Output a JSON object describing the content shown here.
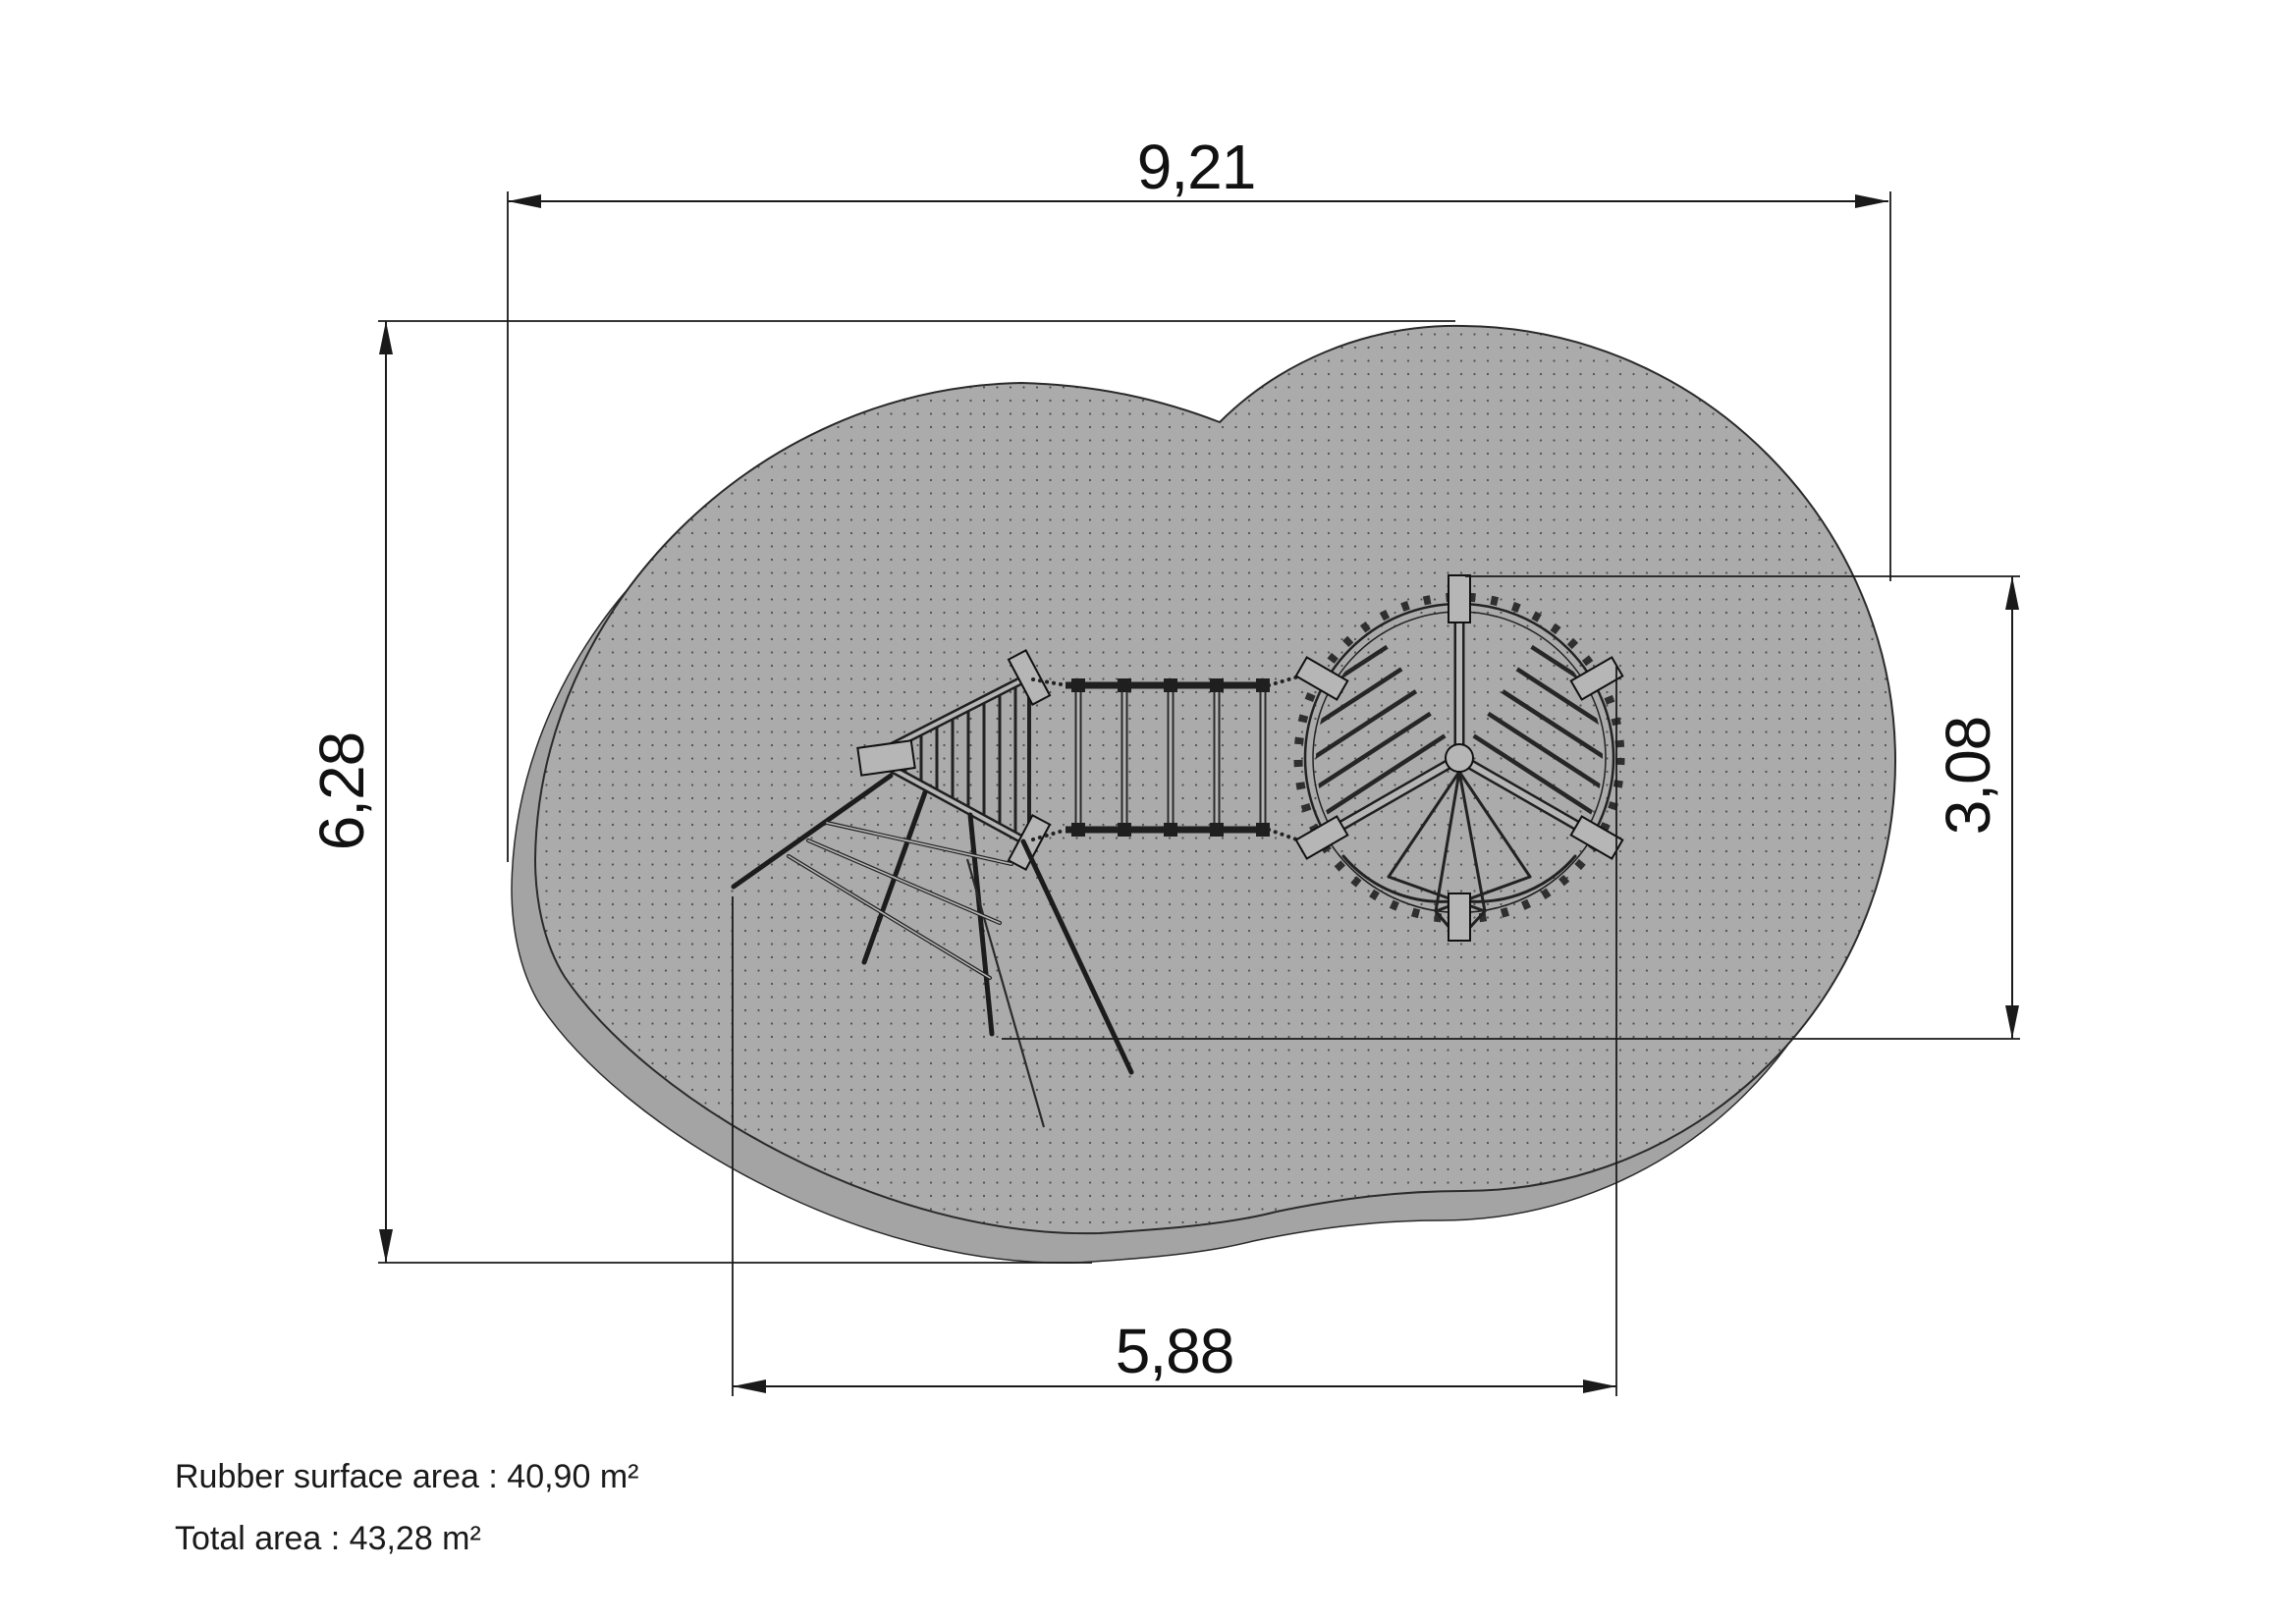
{
  "drawing": {
    "title": "playground-safety-surface-plan",
    "dimensions": {
      "width_total": "9,21",
      "height_total": "6,28",
      "height_right": "3,08",
      "width_bottom": "5,88"
    },
    "notes": {
      "rubber_surface_area": "Rubber surface area : 40,90 m²",
      "total_area": "Total area : 43,28 m²"
    },
    "colors": {
      "background": "#ffffff",
      "surface_top": "#ababab",
      "surface_side": "#a4a4a4",
      "surface_dots": "#4f4f4f",
      "drawing_lines": "#1a1a1a",
      "equipment_beams": "#b6b6b6"
    }
  }
}
